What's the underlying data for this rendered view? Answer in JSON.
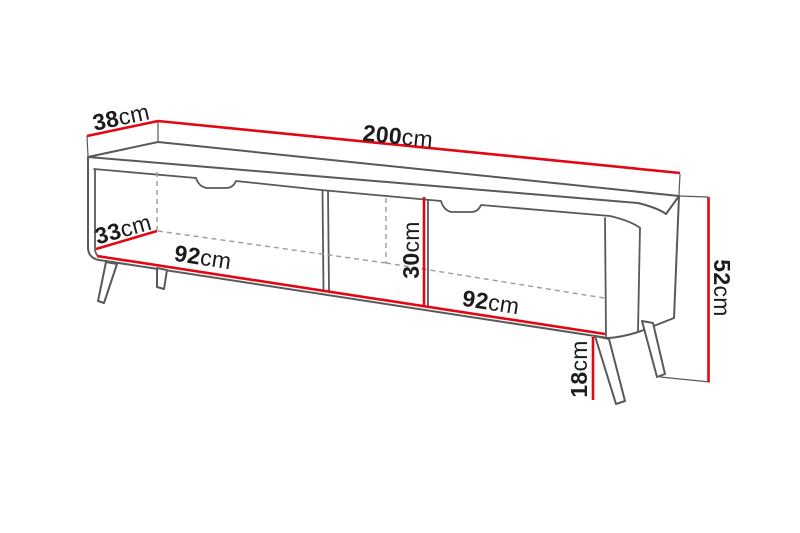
{
  "diagram": {
    "kind": "furniture-dimension-diagram",
    "subject": "tv-stand-with-two-doors-open-middle-shelf-and-splayed-legs",
    "dimensions": {
      "depth_top": {
        "value": "38",
        "unit": "cm"
      },
      "width_total": {
        "value": "200",
        "unit": "cm"
      },
      "depth_interior": {
        "value": "33",
        "unit": "cm"
      },
      "width_left_section": {
        "value": "92",
        "unit": "cm"
      },
      "height_open_shelf": {
        "value": "30",
        "unit": "cm"
      },
      "width_right_section": {
        "value": "92",
        "unit": "cm"
      },
      "height_total": {
        "value": "52",
        "unit": "cm"
      },
      "height_legs": {
        "value": "18",
        "unit": "cm"
      }
    },
    "colors": {
      "dimension_line": "#e30613",
      "outline": "#58595b",
      "hidden_line": "#9b9b9b",
      "text": "#1c1c1c",
      "surface": "#ffffff",
      "background": "#ffffff"
    }
  }
}
